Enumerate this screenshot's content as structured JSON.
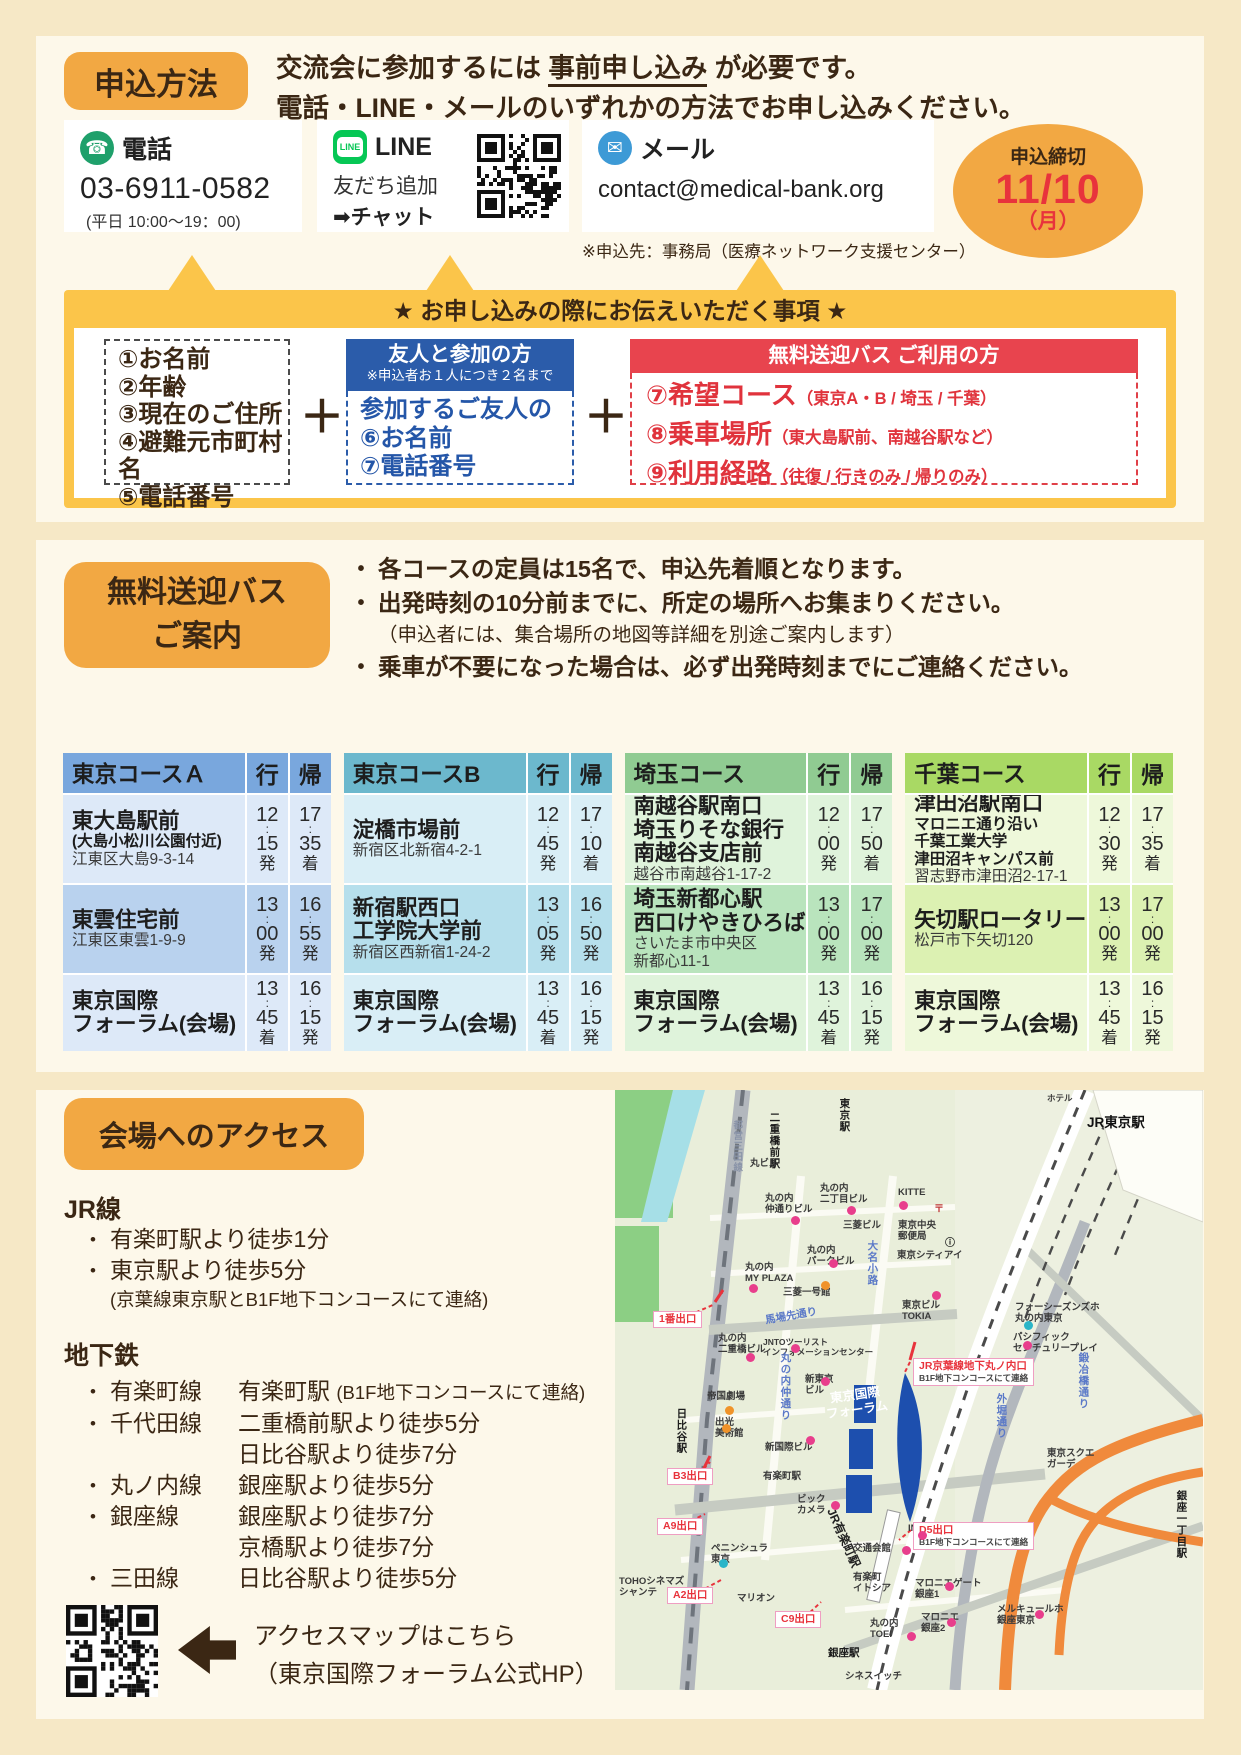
{
  "colors": {
    "accent_orange": "#f2a843",
    "banner_yellow": "#fbc54a",
    "red": "#e8444e",
    "blue": "#2b5caa",
    "deadline_red": "#e8333c",
    "forum_blue": "#1d4fae"
  },
  "apply": {
    "badge": "申込方法",
    "headline1_pre": "交流会に参加するには ",
    "headline1_u": "事前申し込み",
    "headline1_post": " が必要です。",
    "headline2": "電話・LINE・メールのいずれかの方法でお申し込みください。",
    "phone": {
      "label": "電話",
      "number": "03-6911-0582",
      "hours": "(平日 10:00〜19：00)"
    },
    "line": {
      "label": "LINE",
      "icon_text": "LINE",
      "l1": "友だち追加",
      "l2": "➡チャット"
    },
    "mail": {
      "label": "メール",
      "address": "contact@medical-bank.org",
      "note": "※申込先：事務局（医療ネットワーク支援センター）"
    },
    "deadline": {
      "l1": "申込締切",
      "l2": "11/10",
      "l3": "（月）"
    },
    "banner": "★ お申し込みの際にお伝えいただく事項 ★",
    "plus": "＋",
    "box1": {
      "items": [
        "①お名前",
        "②年齢",
        "③現在のご住所",
        "④避難元市町村名",
        "⑤電話番号"
      ]
    },
    "box2": {
      "title": "友人と参加の方",
      "subtitle": "※申込者お１人につき２名まで",
      "lines": [
        "参加するご友人の",
        "⑥お名前",
        "⑦電話番号"
      ]
    },
    "box3": {
      "title": "無料送迎バス ご利用の方",
      "items": [
        {
          "main": "⑦希望コース",
          "sub": "（東京A・B / 埼玉 / 千葉）"
        },
        {
          "main": "⑧乗車場所",
          "sub": "（東大島駅前、南越谷駅など）"
        },
        {
          "main": "⑨利用経路",
          "sub": "（往復 / 行きのみ / 帰りのみ）"
        }
      ]
    }
  },
  "bus": {
    "badge1": "無料送迎バス",
    "badge2": "ご案内",
    "notes": [
      {
        "text": "各コースの定員は15名で、申込先着順となります。",
        "bullet": true,
        "bold": true
      },
      {
        "text": "出発時刻の10分前までに、所定の場所へお集まりください。",
        "bullet": true,
        "bold": true
      },
      {
        "text": "（申込者には、集合場所の地図等詳細を別途ご案内します）",
        "bullet": false,
        "bold": false
      },
      {
        "text": "乗車が不要になった場合は、必ず出発時刻までにご連絡ください。",
        "bullet": true,
        "bold": true
      }
    ],
    "col_go": "行",
    "col_back": "帰",
    "courses": [
      {
        "title": "東京コースＡ",
        "theme": "a",
        "rows": [
          {
            "bold": [
              "東大島駅前"
            ],
            "semi": [
              "(大島小松川公園付近)"
            ],
            "addr": [
              "江東区大島9-3-14"
            ],
            "go": [
              "12",
              "15",
              "発"
            ],
            "back": [
              "17",
              "35",
              "着"
            ]
          },
          {
            "bold": [
              "東雲住宅前"
            ],
            "semi": [],
            "addr": [
              "江東区東雲1-9-9"
            ],
            "go": [
              "13",
              "00",
              "発"
            ],
            "back": [
              "16",
              "55",
              "発"
            ]
          },
          {
            "bold": [
              "東京国際",
              "フォーラム(会場)"
            ],
            "semi": [],
            "addr": [],
            "go": [
              "13",
              "45",
              "着"
            ],
            "back": [
              "16",
              "15",
              "発"
            ]
          }
        ]
      },
      {
        "title": "東京コースB",
        "theme": "b",
        "rows": [
          {
            "bold": [
              "淀橋市場前"
            ],
            "semi": [],
            "addr": [
              "新宿区北新宿4-2-1"
            ],
            "go": [
              "12",
              "45",
              "発"
            ],
            "back": [
              "17",
              "10",
              "着"
            ]
          },
          {
            "bold": [
              "新宿駅西口",
              "工学院大学前"
            ],
            "semi": [],
            "addr": [
              "新宿区西新宿1-24-2"
            ],
            "go": [
              "13",
              "05",
              "発"
            ],
            "back": [
              "16",
              "50",
              "発"
            ]
          },
          {
            "bold": [
              "東京国際",
              "フォーラム(会場)"
            ],
            "semi": [],
            "addr": [],
            "go": [
              "13",
              "45",
              "着"
            ],
            "back": [
              "16",
              "15",
              "発"
            ]
          }
        ]
      },
      {
        "title": "埼玉コース",
        "theme": "s",
        "rows": [
          {
            "bold": [
              "南越谷駅南口",
              "埼玉りそな銀行",
              "南越谷支店前"
            ],
            "semi": [],
            "addr": [
              "越谷市南越谷1-17-2"
            ],
            "go": [
              "12",
              "00",
              "発"
            ],
            "back": [
              "17",
              "50",
              "着"
            ]
          },
          {
            "bold": [
              "埼玉新都心駅",
              "西口けやきひろば"
            ],
            "semi": [],
            "addr": [
              "さいたま市中央区",
              "新都心11-1"
            ],
            "go": [
              "13",
              "00",
              "発"
            ],
            "back": [
              "17",
              "00",
              "発"
            ]
          },
          {
            "bold": [
              "東京国際",
              "フォーラム(会場)"
            ],
            "semi": [],
            "addr": [],
            "go": [
              "13",
              "45",
              "着"
            ],
            "back": [
              "16",
              "15",
              "発"
            ]
          }
        ]
      },
      {
        "title": "千葉コース",
        "theme": "c",
        "rows": [
          {
            "bold": [
              "津田沼駅南口"
            ],
            "semi": [
              "マロニエ通り沿い",
              "千葉工業大学",
              "津田沼キャンパス前"
            ],
            "addr": [
              "習志野市津田沼2-17-1"
            ],
            "go": [
              "12",
              "30",
              "発"
            ],
            "back": [
              "17",
              "35",
              "着"
            ]
          },
          {
            "bold": [
              "矢切駅ロータリー"
            ],
            "semi": [],
            "addr": [
              "松戸市下矢切120"
            ],
            "go": [
              "13",
              "00",
              "発"
            ],
            "back": [
              "17",
              "00",
              "発"
            ]
          },
          {
            "bold": [
              "東京国際",
              "フォーラム(会場)"
            ],
            "semi": [],
            "addr": [],
            "go": [
              "13",
              "45",
              "着"
            ],
            "back": [
              "16",
              "15",
              "発"
            ]
          }
        ]
      }
    ]
  },
  "access": {
    "badge": "会場へのアクセス",
    "jr": {
      "heading": "JR線",
      "items": [
        "有楽町駅より徒歩1分",
        "東京駅より徒歩5分"
      ],
      "note": "(京葉線東京駅とB1F地下コンコースにて連絡)"
    },
    "metro": {
      "heading": "地下鉄",
      "items": [
        {
          "line": "有楽町線",
          "desc": [
            {
              "t": "有楽町駅 ",
              "sm": "(B1F地下コンコースにて連絡)"
            }
          ]
        },
        {
          "line": "千代田線",
          "desc": [
            {
              "t": "二重橋前駅より徒歩5分"
            },
            {
              "t": "日比谷駅より徒歩7分"
            }
          ]
        },
        {
          "line": "丸ノ内線",
          "desc": [
            {
              "t": "銀座駅より徒歩5分"
            }
          ]
        },
        {
          "line": "銀座線",
          "desc": [
            {
              "t": "銀座駅より徒歩7分"
            },
            {
              "t": "京橋駅より徒歩7分"
            }
          ]
        },
        {
          "line": "三田線",
          "desc": [
            {
              "t": "日比谷駅より徒歩5分"
            }
          ]
        }
      ]
    },
    "qr_caption1": "アクセスマップはこちら",
    "qr_caption2": "（東京国際フォーラム公式HP）"
  },
  "map": {
    "labels": [
      {
        "t": "都営三田線",
        "x": 116,
        "y": 30,
        "cls": "v line"
      },
      {
        "t": "二重橋前駅",
        "x": 153,
        "y": 22,
        "cls": "v stn"
      },
      {
        "t": "東京駅",
        "x": 223,
        "y": 8,
        "cls": "v stn"
      },
      {
        "t": "JR東京駅",
        "x": 472,
        "y": 25,
        "cls": "big"
      },
      {
        "t": "ホテル",
        "x": 432,
        "y": 3,
        "cls": "bld sm"
      },
      {
        "t": "丸ビル",
        "x": 135,
        "y": 68,
        "cls": "bld"
      },
      {
        "t": "丸の内\n仲通りビル",
        "x": 150,
        "y": 103,
        "cls": "bld"
      },
      {
        "t": "丸の内\n二丁目ビル",
        "x": 205,
        "y": 93,
        "cls": "bld"
      },
      {
        "t": "KITTE",
        "x": 283,
        "y": 97,
        "cls": "bld"
      },
      {
        "t": "三菱ビル",
        "x": 228,
        "y": 130,
        "cls": "bld"
      },
      {
        "t": "東京中央\n郵便局",
        "x": 283,
        "y": 130,
        "cls": "bld"
      },
      {
        "t": "〒",
        "x": 319,
        "y": 114,
        "cls": "post"
      },
      {
        "t": "丸の内\nパークビル",
        "x": 192,
        "y": 155,
        "cls": "bld"
      },
      {
        "t": "大名小路",
        "x": 251,
        "y": 150,
        "cls": "v road"
      },
      {
        "t": "東京シティアイ",
        "x": 282,
        "y": 160,
        "cls": "bld"
      },
      {
        "t": "ⓘ",
        "x": 330,
        "y": 148,
        "cls": "info"
      },
      {
        "t": "丸の内\nMY PLAZA",
        "x": 130,
        "y": 172,
        "cls": "bld"
      },
      {
        "t": "三菱一号館",
        "x": 168,
        "y": 197,
        "cls": "bld"
      },
      {
        "t": "東京ビル\nTOKIA",
        "x": 287,
        "y": 210,
        "cls": "bld"
      },
      {
        "t": "馬場先通り",
        "x": 150,
        "y": 220,
        "cls": "road r12"
      },
      {
        "t": "1番出口",
        "x": 38,
        "y": 221,
        "cls": "exitbox"
      },
      {
        "t": "丸の内\n二重橋ビル",
        "x": 103,
        "y": 243,
        "cls": "bld"
      },
      {
        "t": "JNTOツーリスト\nインフォメーションセンター",
        "x": 148,
        "y": 247,
        "cls": "bld sm"
      },
      {
        "t": "丸の内仲通り",
        "x": 164,
        "y": 262,
        "cls": "v road"
      },
      {
        "t": "新東京\nビル",
        "x": 190,
        "y": 284,
        "cls": "bld"
      },
      {
        "t": "東京国際\nフォーラム",
        "x": 210,
        "y": 298,
        "cls": "forum"
      },
      {
        "t": "JR京葉線地下丸ノ内口",
        "sub": "B1F地下コンコースにて連絡",
        "x": 298,
        "y": 268,
        "cls": "exitbox2"
      },
      {
        "t": "フォーシーズンズホ\n丸の内東京",
        "x": 400,
        "y": 212,
        "cls": "bld"
      },
      {
        "t": "パシフィック\nセンチュリープレイ",
        "x": 398,
        "y": 242,
        "cls": "bld"
      },
      {
        "t": "帝国劇場",
        "x": 92,
        "y": 301,
        "cls": "bld"
      },
      {
        "t": "出光\n美術館",
        "x": 100,
        "y": 327,
        "cls": "bld"
      },
      {
        "t": "新国際ビル",
        "x": 150,
        "y": 352,
        "cls": "bld"
      },
      {
        "t": "日比谷駅",
        "x": 60,
        "y": 318,
        "cls": "v stn"
      },
      {
        "t": "B3出口",
        "x": 52,
        "y": 378,
        "cls": "exitbox"
      },
      {
        "t": "有楽町駅",
        "x": 148,
        "y": 381,
        "cls": "bld"
      },
      {
        "t": "ビック\nカメラ",
        "x": 182,
        "y": 404,
        "cls": "bld"
      },
      {
        "t": "JR有楽町駅",
        "x": 222,
        "y": 416,
        "cls": "jrline"
      },
      {
        "t": "A9出口",
        "x": 42,
        "y": 428,
        "cls": "exitbox"
      },
      {
        "t": "ペニンシュラ\n東京",
        "x": 96,
        "y": 453,
        "cls": "bld"
      },
      {
        "t": "INZ",
        "x": 293,
        "y": 433,
        "cls": "bld"
      },
      {
        "t": "交通会館",
        "x": 238,
        "y": 453,
        "cls": "bld"
      },
      {
        "t": "D5出口",
        "sub": "B1F地下コンコースにて連絡",
        "x": 298,
        "y": 432,
        "cls": "exitbox2"
      },
      {
        "t": "外堀通り",
        "x": 380,
        "y": 303,
        "cls": "v road"
      },
      {
        "t": "鍛冶橋通り",
        "x": 462,
        "y": 262,
        "cls": "v road"
      },
      {
        "t": "東京スクエ\nガーデ",
        "x": 432,
        "y": 358,
        "cls": "bld"
      },
      {
        "t": "銀座一丁目駅",
        "x": 560,
        "y": 400,
        "cls": "v stn"
      },
      {
        "t": "A2出口",
        "x": 52,
        "y": 497,
        "cls": "exitbox"
      },
      {
        "t": "マリオン",
        "x": 122,
        "y": 503,
        "cls": "bld"
      },
      {
        "t": "TOHOシネマズ\nシャンテ",
        "x": 4,
        "y": 486,
        "cls": "bld"
      },
      {
        "t": "C9出口",
        "x": 160,
        "y": 521,
        "cls": "exitbox"
      },
      {
        "t": "有楽町\nイトシア",
        "x": 238,
        "y": 482,
        "cls": "bld"
      },
      {
        "t": "マロニエゲート\n銀座1",
        "x": 300,
        "y": 488,
        "cls": "bld"
      },
      {
        "t": "マロニエ\n銀座2",
        "x": 306,
        "y": 522,
        "cls": "bld"
      },
      {
        "t": "丸の内\nTOEI",
        "x": 255,
        "y": 528,
        "cls": "bld"
      },
      {
        "t": "銀座駅",
        "x": 213,
        "y": 557,
        "cls": "stn"
      },
      {
        "t": "メルキュールホ\n銀座東京",
        "x": 382,
        "y": 514,
        "cls": "bld"
      },
      {
        "t": "シネスイッチ",
        "x": 230,
        "y": 581,
        "cls": "bld"
      }
    ],
    "dots": [
      {
        "x": 176,
        "y": 126,
        "c": "#e83e8c"
      },
      {
        "x": 232,
        "y": 116,
        "c": "#e83e8c"
      },
      {
        "x": 284,
        "y": 111,
        "c": "#e83e8c"
      },
      {
        "x": 214,
        "y": 169,
        "c": "#e83e8c"
      },
      {
        "x": 134,
        "y": 194,
        "c": "#e83e8c"
      },
      {
        "x": 131,
        "y": 263,
        "c": "#e83e8c"
      },
      {
        "x": 206,
        "y": 287,
        "c": "#e83e8c"
      },
      {
        "x": 317,
        "y": 201,
        "c": "#e83e8c"
      },
      {
        "x": 191,
        "y": 346,
        "c": "#e83e8c"
      },
      {
        "x": 216,
        "y": 411,
        "c": "#e83e8c"
      },
      {
        "x": 303,
        "y": 441,
        "c": "#e83e8c"
      },
      {
        "x": 287,
        "y": 456,
        "c": "#e83e8c"
      },
      {
        "x": 408,
        "y": 251,
        "c": "#e83e8c"
      },
      {
        "x": 330,
        "y": 492,
        "c": "#e83e8c"
      },
      {
        "x": 332,
        "y": 528,
        "c": "#e83e8c"
      },
      {
        "x": 292,
        "y": 542,
        "c": "#e83e8c"
      },
      {
        "x": 420,
        "y": 520,
        "c": "#e83e8c"
      },
      {
        "x": 176,
        "y": 254,
        "c": "#e83e8c"
      },
      {
        "x": 206,
        "y": 191,
        "c": "#f0932a"
      },
      {
        "x": 110,
        "y": 316,
        "c": "#f0932a"
      },
      {
        "x": 107,
        "y": 334,
        "c": "#f0932a"
      },
      {
        "x": 409,
        "y": 231,
        "c": "#2ab5c8"
      },
      {
        "x": 104,
        "y": 469,
        "c": "#2ab5c8"
      }
    ]
  }
}
